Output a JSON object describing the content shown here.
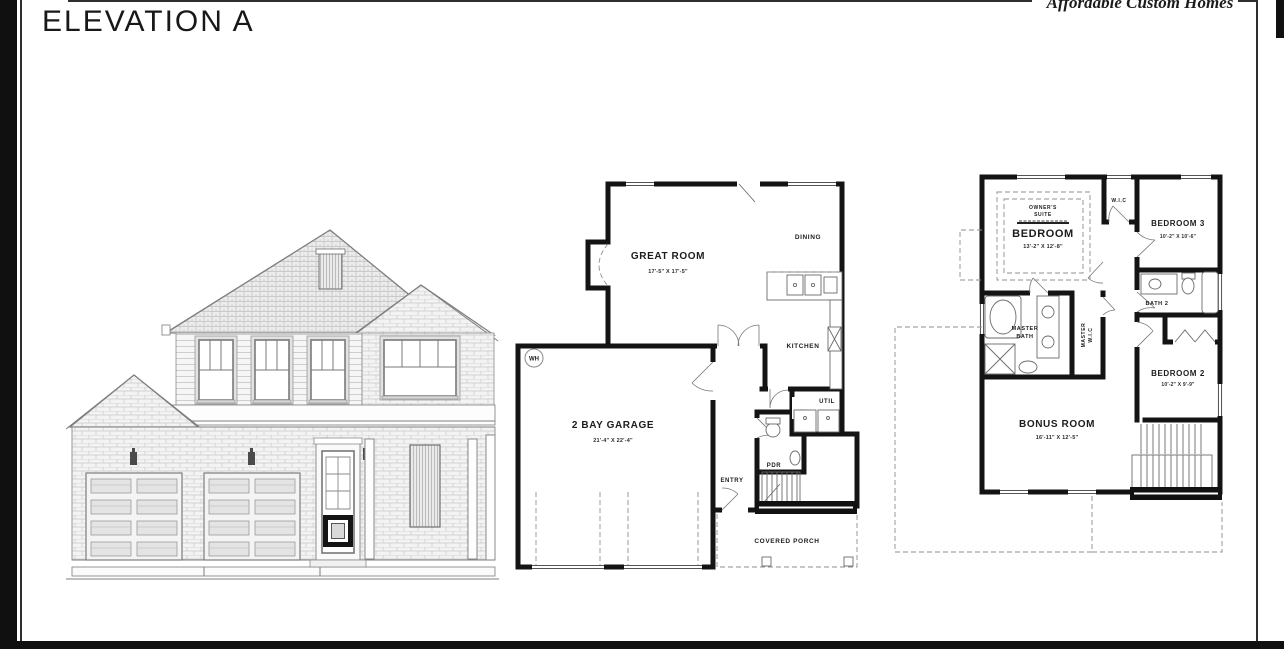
{
  "page": {
    "title": "ELEVATION A",
    "brand": "Affordable Custom Homes"
  },
  "floor1": {
    "great_room": "GREAT ROOM",
    "great_room_dims": "17'-5\" X 17'-5\"",
    "dining": "DINING",
    "kitchen": "KITCHEN",
    "util": "UTIL",
    "pdr": "PDR",
    "entry": "ENTRY",
    "covered_porch": "COVERED PORCH",
    "garage": "2 BAY GARAGE",
    "garage_dims": "21'-4\" X 22'-4\"",
    "wh": "WH"
  },
  "floor2": {
    "owners_line1": "OWNER'S",
    "owners_line2": "SUITE",
    "bedroom": "BEDROOM",
    "bedroom_dims": "13'-2\" X 12'-8\"",
    "wic": "W.I.C",
    "bedroom3": "BEDROOM 3",
    "bedroom3_dims": "10'-2\" X 10'-6\"",
    "bath2": "BATH 2",
    "master_line1": "MASTER",
    "master_line2": "BATH",
    "master_wic_line1": "MASTER",
    "master_wic_line2": "W.I.C",
    "bedroom2": "BEDROOM 2",
    "bedroom2_dims": "10'-2\" X 9'-9\"",
    "bonus": "BONUS ROOM",
    "bonus_dims": "16'-11\" X 12'-5\""
  }
}
